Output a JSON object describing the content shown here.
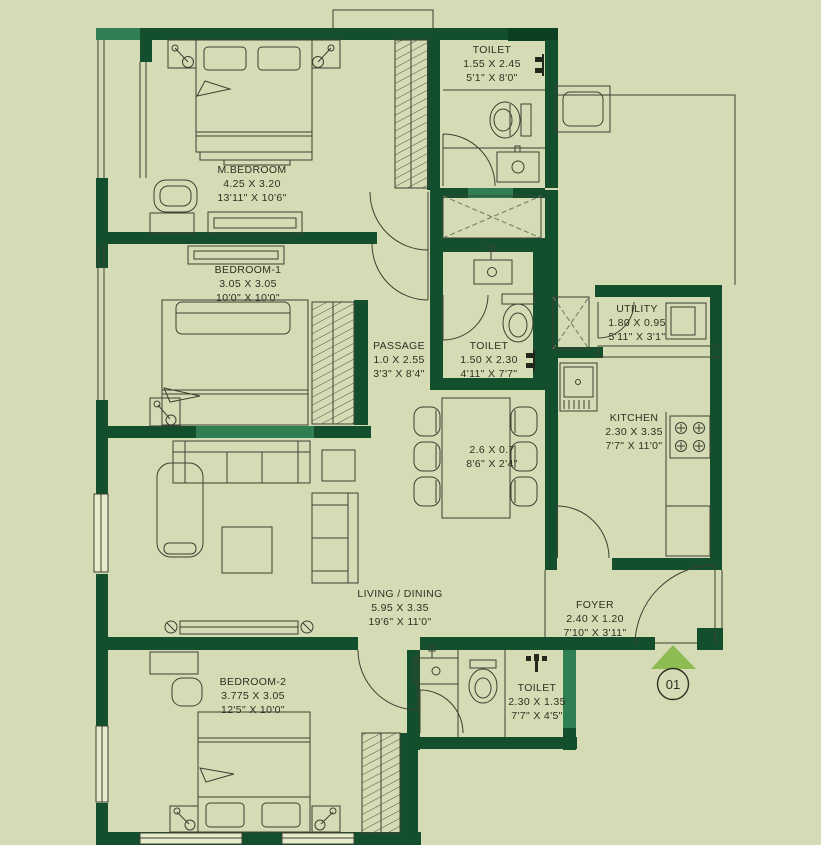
{
  "unit": {
    "marker": "01"
  },
  "rooms": {
    "mbedroom": {
      "name": "M.BEDROOM",
      "metric": "4.25 X 3.20",
      "imperial": "13'11\" X 10'6\""
    },
    "toilet_top": {
      "name": "TOILET",
      "metric": "1.55 X 2.45",
      "imperial": "5'1\" X 8'0\""
    },
    "bedroom1": {
      "name": "BEDROOM-1",
      "metric": "3.05 X 3.05",
      "imperial": "10'0\" X 10'0\""
    },
    "passage": {
      "name": "PASSAGE",
      "metric": "1.0 X 2.55",
      "imperial": "3'3\" X 8'4\""
    },
    "toilet_mid": {
      "name": "TOILET",
      "metric": "1.50 X 2.30",
      "imperial": "4'11\" X 7'7\""
    },
    "utility": {
      "name": "UTILITY",
      "metric": "1.80 X 0.95",
      "imperial": "5'11\" X 3'1\""
    },
    "kitchen": {
      "name": "KITCHEN",
      "metric": "2.30 X 3.35",
      "imperial": "7'7\" X 11'0\""
    },
    "dining_table": {
      "metric": "2.6 X 0.7",
      "imperial": "8'6\" X 2'4\""
    },
    "living_dining": {
      "name": "LIVING / DINING",
      "metric": "5.95 X 3.35",
      "imperial": "19'6\" X 11'0\""
    },
    "foyer": {
      "name": "FOYER",
      "metric": "2.40 X 1.20",
      "imperial": "7'10\" X 3'11\""
    },
    "bedroom2": {
      "name": "BEDROOM-2",
      "metric": "3.775 X 3.05",
      "imperial": "12'5\" X 10'0\""
    },
    "toilet_bottom": {
      "name": "TOILET",
      "metric": "2.30 X 1.35",
      "imperial": "7'7\" X 4'5\""
    }
  },
  "colors": {
    "background": "#d5dbb4",
    "wall": "#134e2d",
    "wall_light": "#2f7f52",
    "wall_dark": "#0c4023",
    "line": "#3c4132",
    "entry_arrow": "#8fbc52"
  }
}
